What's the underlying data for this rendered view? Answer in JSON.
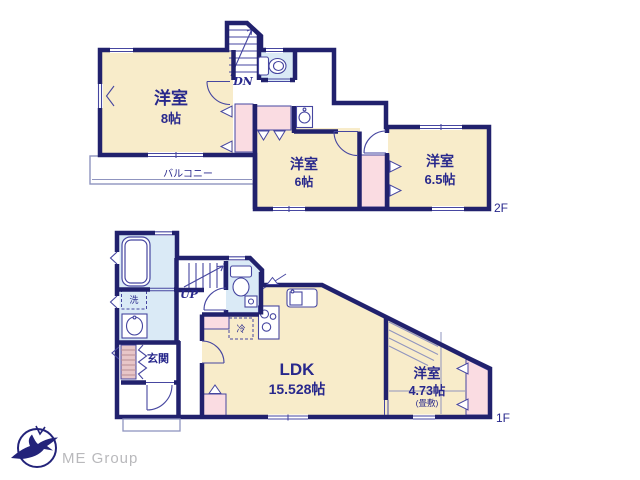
{
  "floor2": {
    "label": "2F",
    "rooms": {
      "west8": {
        "name": "洋室",
        "size": "8帖"
      },
      "mid6": {
        "name": "洋室",
        "size": "6帖"
      },
      "east65": {
        "name": "洋室",
        "size": "6.5帖"
      }
    },
    "balcony_label": "バルコニー",
    "stair_label": "DN"
  },
  "floor1": {
    "label": "1F",
    "rooms": {
      "ldk": {
        "name": "LDK",
        "size": "15.528帖"
      },
      "tatami": {
        "name": "洋室",
        "size": "4.73帖",
        "note": "(畳敷)"
      }
    },
    "entrance_label": "玄関",
    "laundry_label": "洗",
    "fridge_label": "冷",
    "stair_label": "UP"
  },
  "logo": {
    "text": "ME Group"
  },
  "colors": {
    "wall": "#21216d",
    "room_cream": "#f8ecca",
    "closet_pink": "#fadce2",
    "wet_blue": "#daeaf6",
    "text_navy": "#28288c",
    "logo_gray": "#b9b9bc"
  }
}
